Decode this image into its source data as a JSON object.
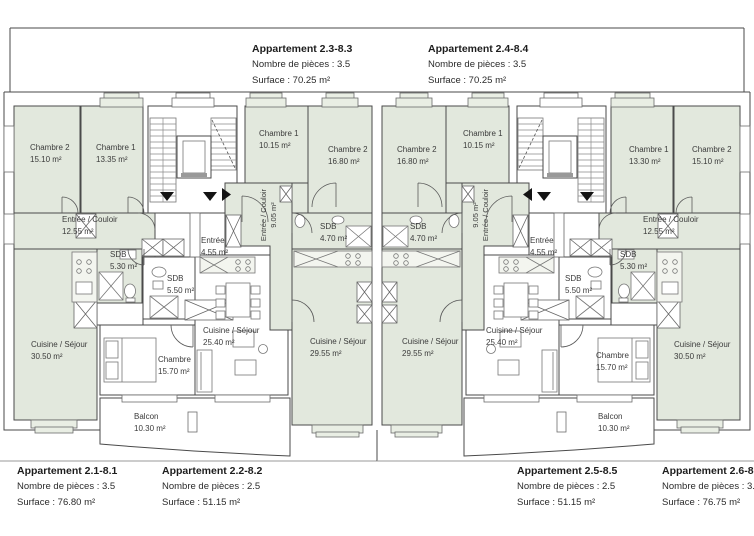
{
  "palette": {
    "room_fill": "#e2e8dd",
    "window_box_fill": "#e9eee4",
    "wall": "#4a4a4a",
    "furniture": "#777777",
    "ground_line": "#9a9a9a",
    "label_text": "#3b3b3b",
    "title_text": "#1d1d1d",
    "background": "#ffffff"
  },
  "units_top": [
    {
      "title": "Appartement 2.3-8.3",
      "pieces": "Nombre de pièces : 3.5",
      "surface": "Surface : 70.25 m²"
    },
    {
      "title": "Appartement 2.4-8.4",
      "pieces": "Nombre de pièces : 3.5",
      "surface": "Surface : 70.25 m²"
    }
  ],
  "units_bottom": [
    {
      "title": "Appartement 2.1-8.1",
      "pieces": "Nombre de pièces : 3.5",
      "surface": "Surface : 76.80 m²"
    },
    {
      "title": "Appartement 2.2-8.2",
      "pieces": "Nombre de pièces : 2.5",
      "surface": "Surface : 51.15 m²"
    },
    {
      "title": "Appartement 2.5-8.5",
      "pieces": "Nombre de pièces : 2.5",
      "surface": "Surface : 51.15 m²"
    },
    {
      "title": "Appartement 2.6-8.6",
      "pieces": "Nombre de pièces : 3.5",
      "surface": "Surface : 76.75 m²"
    }
  ],
  "rooms_left": {
    "chambre2_a": {
      "name": "Chambre 2",
      "area": "15.10 m²"
    },
    "chambre1_a": {
      "name": "Chambre 1",
      "area": "13.35 m²"
    },
    "chambre1_b": {
      "name": "Chambre 1",
      "area": "10.15 m²"
    },
    "chambre2_b": {
      "name": "Chambre 2",
      "area": "16.80 m²"
    },
    "entree_couloir": {
      "name": "Entrée / Couloir",
      "area": "12.55 m²"
    },
    "sdb_530": {
      "name": "SDB",
      "area": "5.30 m²"
    },
    "entree": {
      "name": "Entrée",
      "area": "4.55 m²"
    },
    "sdb_550": {
      "name": "SDB",
      "area": "5.50 m²"
    },
    "entree_couloir_v": {
      "name": "Entrée / Couloir",
      "area": "9.05 m²"
    },
    "sdb_470": {
      "name": "SDB",
      "area": "4.70 m²"
    },
    "cuisine_3050": {
      "name": "Cuisine / Séjour",
      "area": "30.50 m²"
    },
    "chambre_1570": {
      "name": "Chambre",
      "area": "15.70 m²"
    },
    "cuisine_2540": {
      "name": "Cuisine / Séjour",
      "area": "25.40 m²"
    },
    "cuisine_2955": {
      "name": "Cuisine / Séjour",
      "area": "29.55 m²"
    },
    "balcon": {
      "name": "Balcon",
      "area": "10.30 m²"
    }
  },
  "rooms_right": {
    "chambre2_a": {
      "name": "Chambre 2",
      "area": "15.10 m²"
    },
    "chambre1_a": {
      "name": "Chambre 1",
      "area": "13.30 m²"
    },
    "chambre1_b": {
      "name": "Chambre 1",
      "area": "10.15 m²"
    },
    "chambre2_b": {
      "name": "Chambre 2",
      "area": "16.80 m²"
    },
    "entree_couloir": {
      "name": "Entrée / Couloir",
      "area": "12.55 m²"
    },
    "sdb_530": {
      "name": "SDB",
      "area": "5.30 m²"
    },
    "entree": {
      "name": "Entrée",
      "area": "4.55 m²"
    },
    "sdb_550": {
      "name": "SDB",
      "area": "5.50 m²"
    },
    "entree_couloir_v": {
      "name": "Entrée / Couloir",
      "area": "9.05 m²"
    },
    "sdb_470": {
      "name": "SDB",
      "area": "4.70 m²"
    },
    "cuisine_3050": {
      "name": "Cuisine / Séjour",
      "area": "30.50 m²"
    },
    "chambre_1570": {
      "name": "Chambre",
      "area": "15.70 m²"
    },
    "cuisine_2540": {
      "name": "Cuisine / Séjour",
      "area": "25.40 m²"
    },
    "cuisine_2955": {
      "name": "Cuisine / Séjour",
      "area": "29.55 m²"
    },
    "balcon": {
      "name": "Balcon",
      "area": "10.30 m²"
    }
  }
}
